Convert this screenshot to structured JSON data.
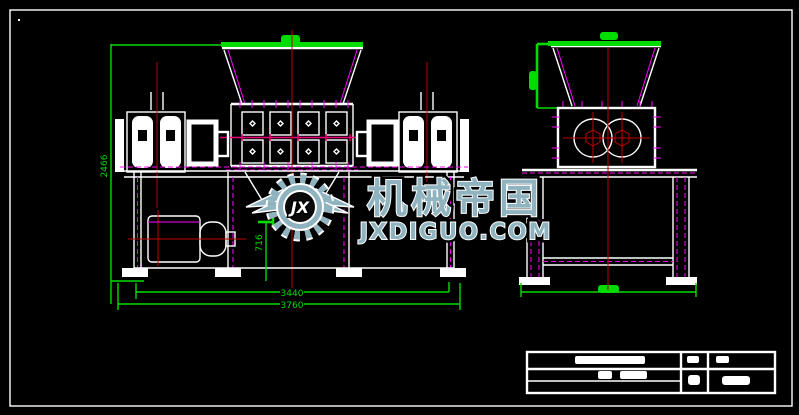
{
  "drawing": {
    "dimensions": {
      "overall_height": "2466",
      "discharge_height": "716",
      "base_width": "3440",
      "overall_width": "3760"
    },
    "watermark": {
      "logo_monogram": "JX",
      "brand": "机械帝国",
      "site": "JXDIGUO.COM",
      "color": "#8FB3BF"
    },
    "colors": {
      "background": "#000000",
      "outline": "#FFFFFF",
      "dimension_green": "#00DC00",
      "centerline_red": "#C00000",
      "detail_magenta": "#FF00FF"
    }
  }
}
